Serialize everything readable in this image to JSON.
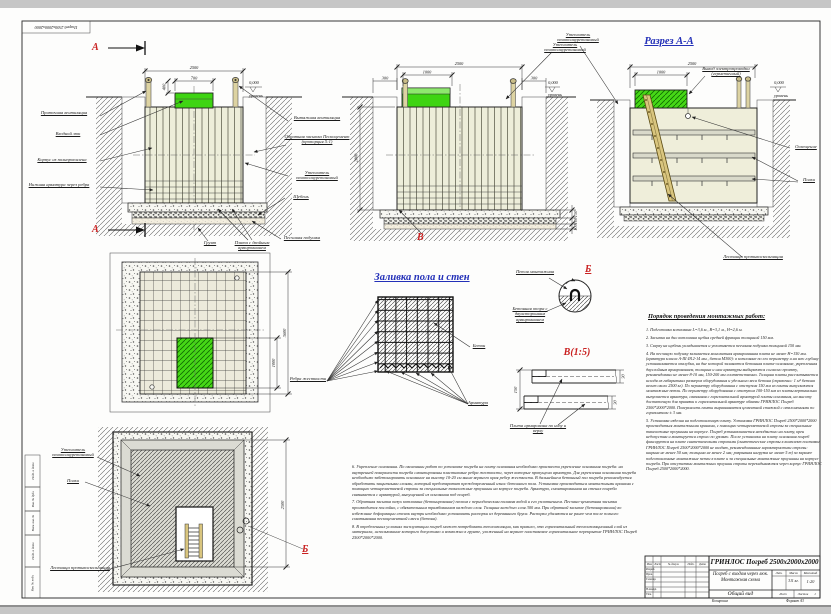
{
  "frame": {
    "corner_stamp": "Погреб 2500x2000x2000",
    "left_stamp": [
      "Подп. и дата",
      "Инв. № дубл.",
      "Взам. инв. №",
      "Подп. и дата",
      "Инв. № подл."
    ],
    "copied_label": "Копировал",
    "format_label": "Формат А3"
  },
  "views": {
    "section_a": {
      "mark": "А",
      "dims": {
        "width": "2500",
        "lid": "700",
        "lid_h": "400",
        "level": "0,000",
        "level_word": "уровень"
      },
      "left_labels": [
        "Приточная вентиляция",
        "Входной люк",
        "Корпус из полипропилена",
        "Нижняя арматура через ребра"
      ],
      "right_labels": [
        "Вытяжная вентиляция",
        "Обратная засыпка Пескоцемент (пропорция 5:1)",
        "Утеплитель пенополиуретановый",
        "Щебень",
        "Песчаная подушка"
      ],
      "bottom_labels": [
        "Грунт",
        "Плита с двойным армированием"
      ]
    },
    "section_b": {
      "mark": "В",
      "dims": {
        "width": "2500",
        "lid": "1000",
        "side_left": "300",
        "side_right": "300",
        "height": "2000",
        "plate": "150",
        "gravel": "100",
        "sand": "100",
        "level": "0,000",
        "level_word": "уровень"
      },
      "insulation": "Утеплитель пенополиуретановый"
    },
    "section_aa": {
      "title": "Разрез А-А",
      "dims": {
        "width": "2500",
        "lid": "1000",
        "level": "0,000",
        "level_word": "уровень"
      },
      "insulation": "Утеплитель пенополиуретановый",
      "wiring": "Вывод электропроводки (герметичный)",
      "light": "Освещение",
      "shelves": "Полки",
      "ladder": "Лестница противоскользящая"
    },
    "plan": {
      "dim_outer": "3600",
      "dim_hatch": "1000"
    },
    "bottom_plan": {
      "mark": "Б",
      "dim": "2500",
      "insulation": "Утеплитель пенополиуретановый",
      "shelves": "Полки",
      "ladder": "Лестница противоскользящая"
    },
    "pour": {
      "title": "Заливка пола и стен",
      "ribs": "Ребра жесткости",
      "concrete": "Бетон",
      "rebar": "Арматура"
    },
    "detail_b": {
      "mark": "Б",
      "loop": "Петля монтажная",
      "support": "Бетонная опора с двухсторонним армированием"
    },
    "detail_v": {
      "title": "В(1:5)",
      "dim_h": "150",
      "dim_t1": "30",
      "dim_t2": "30",
      "plate": "Плита армирована по низу и верху"
    }
  },
  "instructions": {
    "title": "Порядок проведения монтажных работ:",
    "items": [
      "1. Подготовка котлована L=3,6 м., В=3,1 м., Н=2,6 м.",
      "2. Засыпка на дно котлована щебня средней фракции толщиной 150 мм.",
      "3. Сверху на щебень укладывается и уплотняется песчаная подушка толщиной 150 мм.",
      "4. На песчаную подушку заливается монолитная армированная плита не менее Н=150 мм. (арматура класса А-III Ø12-14 мм., бетон М300): в котловане по его периметру и на всю глубину устанавливается опалубка, на дне которой заливается бетонная плита-основание, укрепленная двуслойным армированием, толщина и шаг арматуры выбираются согласно проекту, рекомендовано не менее 8-10 мм, 150-200 мм соответственно. Толщина плиты рассчитывается исходя из габаритных размеров оборудования и удельного веса бетона (справочно: 1 м³ бетона весит около 2500 кг). По периметру оборудования с отступом 150 мм из плиты выпускаются монтажные петли. По периметру оборудования с отступом 100-150 мм из плиты вертикально выпускается арматура, связанная с горизонтальной арматурой плиты основания, на высоту достаточную для привязки к горизонтальной арматуре обвязки ГРИНЛОС Погреб 2500*2000*2000. Поверхность плиты выравнивается цементной стяжкой с отклонениями по горизонтали ± 3 мм.",
      "5. Установка изделия на подготовленную плиту. Установка ГРИНЛОС Погреб 2500*2000*2000 производиться монтажными кранами, с помощью четырехветвевой стропы за специальные такелажные проушины на корпусе. Погреб устанавливается неподвижно на плиту, крен недопустим и монтируется строго по уровню. После установки на плиту основания погреб фиксируется на плите синтетическими стропами (синтетические стропы в комплект поставки ГРИНЛОС Погреб 2500*2000*2000 не входят, рекомендованные характеристики стропы: ширина не менее 50 мм; толщина не менее 2 мм; разрывная нагрузка не менее 5 т) за заранее подготовленные монтажные петли в плите и за специальные монтажные проушины на корпусе погреба. При отсутствии монтажных проушин стропы перекидываются через корпус ГРИНЛОС Погреб 2500*2000*2000."
    ]
  },
  "notes": {
    "items": [
      "6. Укрепление основания. По окончании работ по установке погреба на плиту основания необходимо произвести укрепление основания погреба: на внутренней поверхности погреба смонтированы пластиковые ребра жесткости, через которые пропущена арматура. Для укрепления основания погреба необходимо забетонировать основание на высоту 10-20 см выше верхнего края ребер жесткости. В дальнейшем бетонный пол погреба рекомендуется обработать защитными слоями, который предотвратит преждевременный износ бетонного пола. Установка производиться монтажными кранами с помощью четырехветвевой стропы за специальные такелажные проушины на корпусе погреба. Арматура, смонтированная на стенах погреба связывается с арматурой, выпущенной из основания под погреб.",
      "7. Обратная засыпка пазух котлована (бетонирование) песком с периодическим поливом водой и его уплотнением. Песчано-цементная засыпка производится послойно, с обязательным трамбованием каждого слоя. Толщина каждого слоя 300 мм. При обратной засыпке (бетонировании) во избежание деформации стенок внутри необходимо установить распорки из деревянного бруса. Распорки удаляются не ранее чем после полного схватывания пескоцементной смеси (бетона).",
      "8. В определенных условиях эксплуатации погреб может потребовать теплоизоляции, как правило, это горизонтальный теплоизоляционный слой из материала, использование которого допустимо и возможно в грунте, уложенный на верхнее пластиковое горизонтальное перекрытие ГРИНЛОС Погреб 2500*2000*2000."
    ]
  },
  "titleblock": {
    "product": "ГРИНЛОС Погреб 2500x2000x2000",
    "doc_title": "Погреб с входом через люк. Монтажная схема",
    "view_name": "Общий вид",
    "mass": "311 кг.",
    "scale": "1:20",
    "col_headers": [
      "Изм.",
      "Лист",
      "№ докум.",
      "Подп.",
      "Дата"
    ],
    "rows": [
      "Разраб.",
      "Пров.",
      "Т.контр.",
      "Н.контр.",
      "Утв."
    ],
    "lit_label": "Лит.",
    "mass_label": "Масса",
    "scale_label": "Масштаб",
    "sheet_label": "Лист",
    "sheets_label": "Листов",
    "sheets_value": "1"
  }
}
